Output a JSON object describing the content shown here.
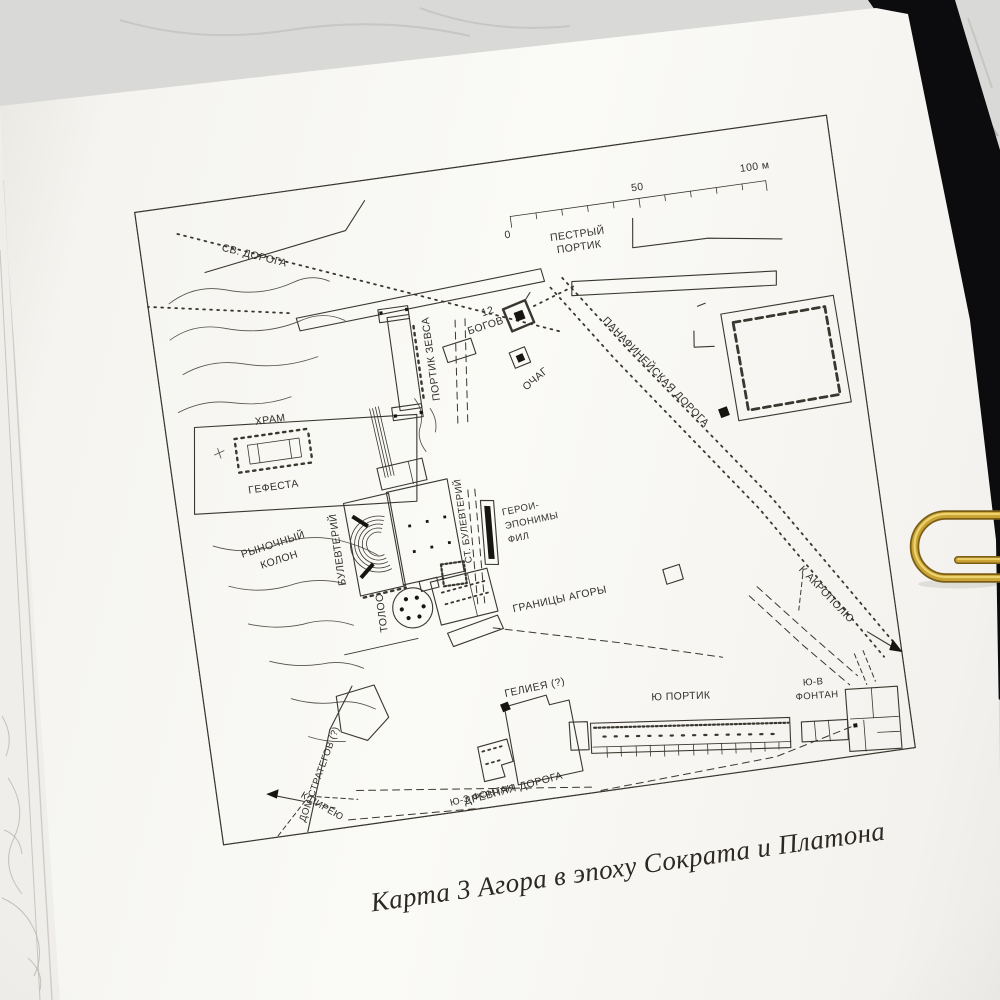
{
  "colors": {
    "paper": "#f8f6f2",
    "map_ink": "#3a372f",
    "marble": "#d9d9d7",
    "book_cover": "#0c0c0e",
    "paperclip_gold": "#c9a335",
    "caption_ink": "#2c2823"
  },
  "map": {
    "caption": "Карта 3 Агора в эпоху Сократа и Платона",
    "scale": {
      "t0": "0",
      "t50": "50",
      "t100": "100 м"
    },
    "labels": {
      "sacred_road": "СВ. ДОРОГА",
      "stoa_poikile_l1": "ПЕСТРЫЙ",
      "stoa_poikile_l2": "ПОРТИК",
      "twelve_gods_l1": "12",
      "twelve_gods_l2": "БОГОВ",
      "hearth": "ОЧАГ",
      "stoa_of_zeus": "ПОРТИК ЗЕВСА",
      "temple_l1": "ХРАМ",
      "temple_l2": "ГЕФЕСТА",
      "panathenaic_way": "ПАНАФИНЕЙСКАЯ ДОРОГА",
      "bouleuterion": "БУЛЕВТЕРИЙ",
      "old_bouleuterion": "СТ. БУЛЕВТЕРИЙ",
      "heroes_l1": "ГЕРОИ-",
      "heroes_l2": "ЭПОНИМЫ",
      "heroes_l3": "ФИЛ",
      "market_hill_l1": "РЫНОЧНЫЙ",
      "market_hill_l2": "КОЛОН",
      "tholos": "ТОЛОС",
      "agora_bounds": "ГРАНИЦЫ АГОРЫ",
      "to_acropolis": "К АКРОПОЛЮ",
      "heliaia": "ГЕЛИЕЯ (?)",
      "south_stoa": "Ю ПОРТИК",
      "se_fountain_l1": "Ю-В",
      "se_fountain_l2": "ФОНТАН",
      "sw_fountain": "Ю-З ФОНТАН",
      "strategeion": "ДОМ СТРАТЕГОВ (?)",
      "ancient_road": "ДРЕВНЯЯ ДОРОГА",
      "to_piraeus": "К ПИРЕЮ"
    }
  }
}
